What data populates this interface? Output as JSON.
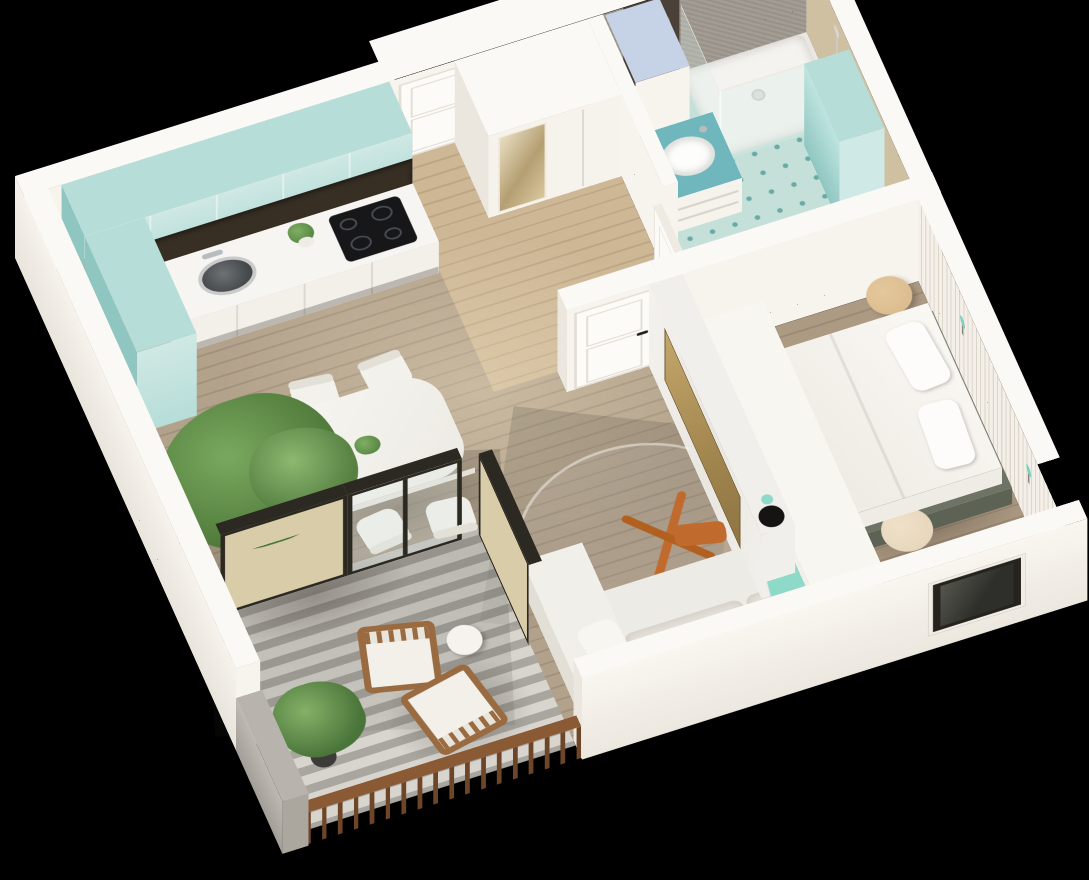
{
  "scene": {
    "type": "3d-isometric-floorplan-render",
    "subject": "one-bedroom apartment cutaway model on black background",
    "background": "#000000"
  },
  "colors": {
    "wall-top": "#fbf9f5",
    "wall-s": "#f7f3ed",
    "wall-w": "#ebe6de",
    "teal": "#b6ddd8",
    "teal-light": "#cfe8e4",
    "teal-deep": "#8fc6c1",
    "teal-counter": "#6fb7bd",
    "mint": "#8fd9c8",
    "sconce": "#7fd0c0",
    "olive": "#6d7465",
    "olive-deep": "#5c6355",
    "gold": "#b89a5e",
    "marble": "#f1efeb",
    "orange": "#c06b2d",
    "wood-liv-a": "#b3a28b",
    "wood-liv-b": "#a2917c",
    "wood-hall-a": "#cdb795",
    "wood-hall-b": "#bda685",
    "wood-bed-a": "#ad9a83",
    "wood-bed-b": "#9c8a75",
    "tile": "#c5dfd9",
    "tile-dot": "#69aaa4",
    "balc-a": "#d8d5cf",
    "balc-b": "#a9a6a0",
    "screen-beige": "#d8cda8",
    "frame-dark": "#2c2822",
    "chair-wood": "#9a6a41",
    "rail-wood": "#8a5a34",
    "stone": "#b8b4ad",
    "glass": "#dfece7",
    "mirror-a": "#e9ddc1",
    "mirror-b": "#b49f72",
    "window-dark": "#26231e",
    "niche": "#372f24",
    "cooktop": "#17171a",
    "green-a": "#79a95f",
    "green-b": "#3e6330",
    "planter": "#3c3b37",
    "bath-wall": "#9e988f",
    "bath-beige": "#cfc0a2",
    "cab-blue": "#c6d2e6",
    "stool-wood": "#d9b88c",
    "pouf": "#e4d3b8",
    "sofa": "#edebe5"
  },
  "rooms": {
    "kitchen": {
      "name": "Kitchen",
      "furniture": [
        "teal upper cabinets",
        "teal tall end unit",
        "white base counter",
        "dark backsplash niche",
        "induction cooktop",
        "round dark sink",
        "potted plant"
      ]
    },
    "dining": {
      "name": "Dining area",
      "furniture": [
        "white rounded dining table",
        "four white chairs",
        "plant centerpiece"
      ]
    },
    "living": {
      "name": "Living room",
      "furniture": [
        "L-shaped cream sofa",
        "mint throw pillow",
        "round glass coffee table",
        "orange folding stool",
        "marble TV partition",
        "brass TV panel",
        "black vase with sprig"
      ]
    },
    "bedroom": {
      "name": "Bedroom",
      "furniture": [
        "double bed with olive frame",
        "white duvet and pillows",
        "round wooden side stools",
        "beige pouf",
        "white drawer unit",
        "slatted accent wall",
        "teal wall sconces",
        "window"
      ]
    },
    "bathroom": {
      "name": "Bathroom",
      "furniture": [
        "corner glass shower",
        "white shower tray",
        "teal vanity with vessel sink",
        "open shelving",
        "tall white cabinet with blue top",
        "tall teal cabinet",
        "round gold mirror on dark panel",
        "teal dotted tile floor"
      ]
    },
    "hallway": {
      "name": "Entry hall",
      "furniture": [
        "white entry door",
        "wardrobe with full-length mirror",
        "open bathroom door"
      ]
    },
    "balcony": {
      "name": "Balcony",
      "furniture": [
        "striped paver floor",
        "wood railing with balusters",
        "beige privacy screens",
        "dark framed glass door",
        "two wooden armchairs with white cushions",
        "round side table",
        "potted shrub",
        "tree in dark planter",
        "stone parapet"
      ]
    }
  }
}
